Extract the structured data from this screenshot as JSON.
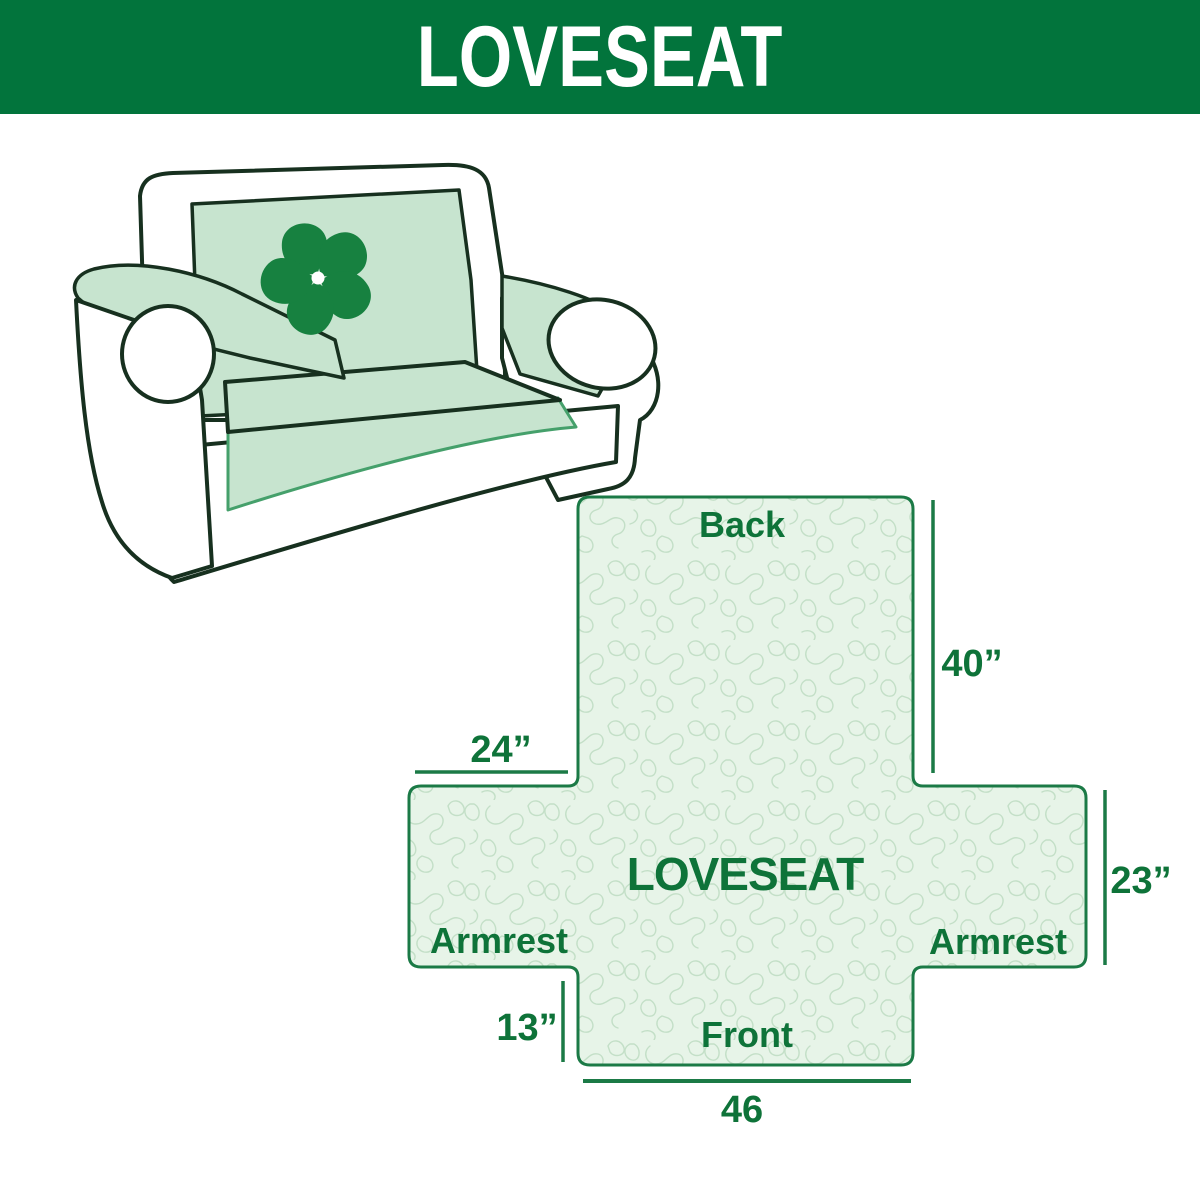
{
  "header": {
    "title": "LOVESEAT"
  },
  "illustration": {
    "description": "loveseat sofa with light green protective cover",
    "logo_icon": "pinwheel-icon"
  },
  "diagram": {
    "center_label": "LOVESEAT",
    "back_label": "Back",
    "front_label": "Front",
    "armrest_left_label": "Armrest",
    "armrest_right_label": "Armrest",
    "dim_back_height": "40”",
    "dim_armrest_width": "24”",
    "dim_armrest_height": "23”",
    "dim_front_height": "13”",
    "dim_front_width": "46"
  },
  "colors": {
    "banner_green": "#02743C",
    "label_green": "#0E7339",
    "outline_green": "#1B7A46",
    "cover_fill": "#C7E4CF",
    "quilt_fill": "#E7F4E8",
    "quilt_line": "#C3DFC7",
    "logo_green": "#178140",
    "sofa_outline": "#17301F",
    "skirt_edge_green": "#45A06B"
  }
}
